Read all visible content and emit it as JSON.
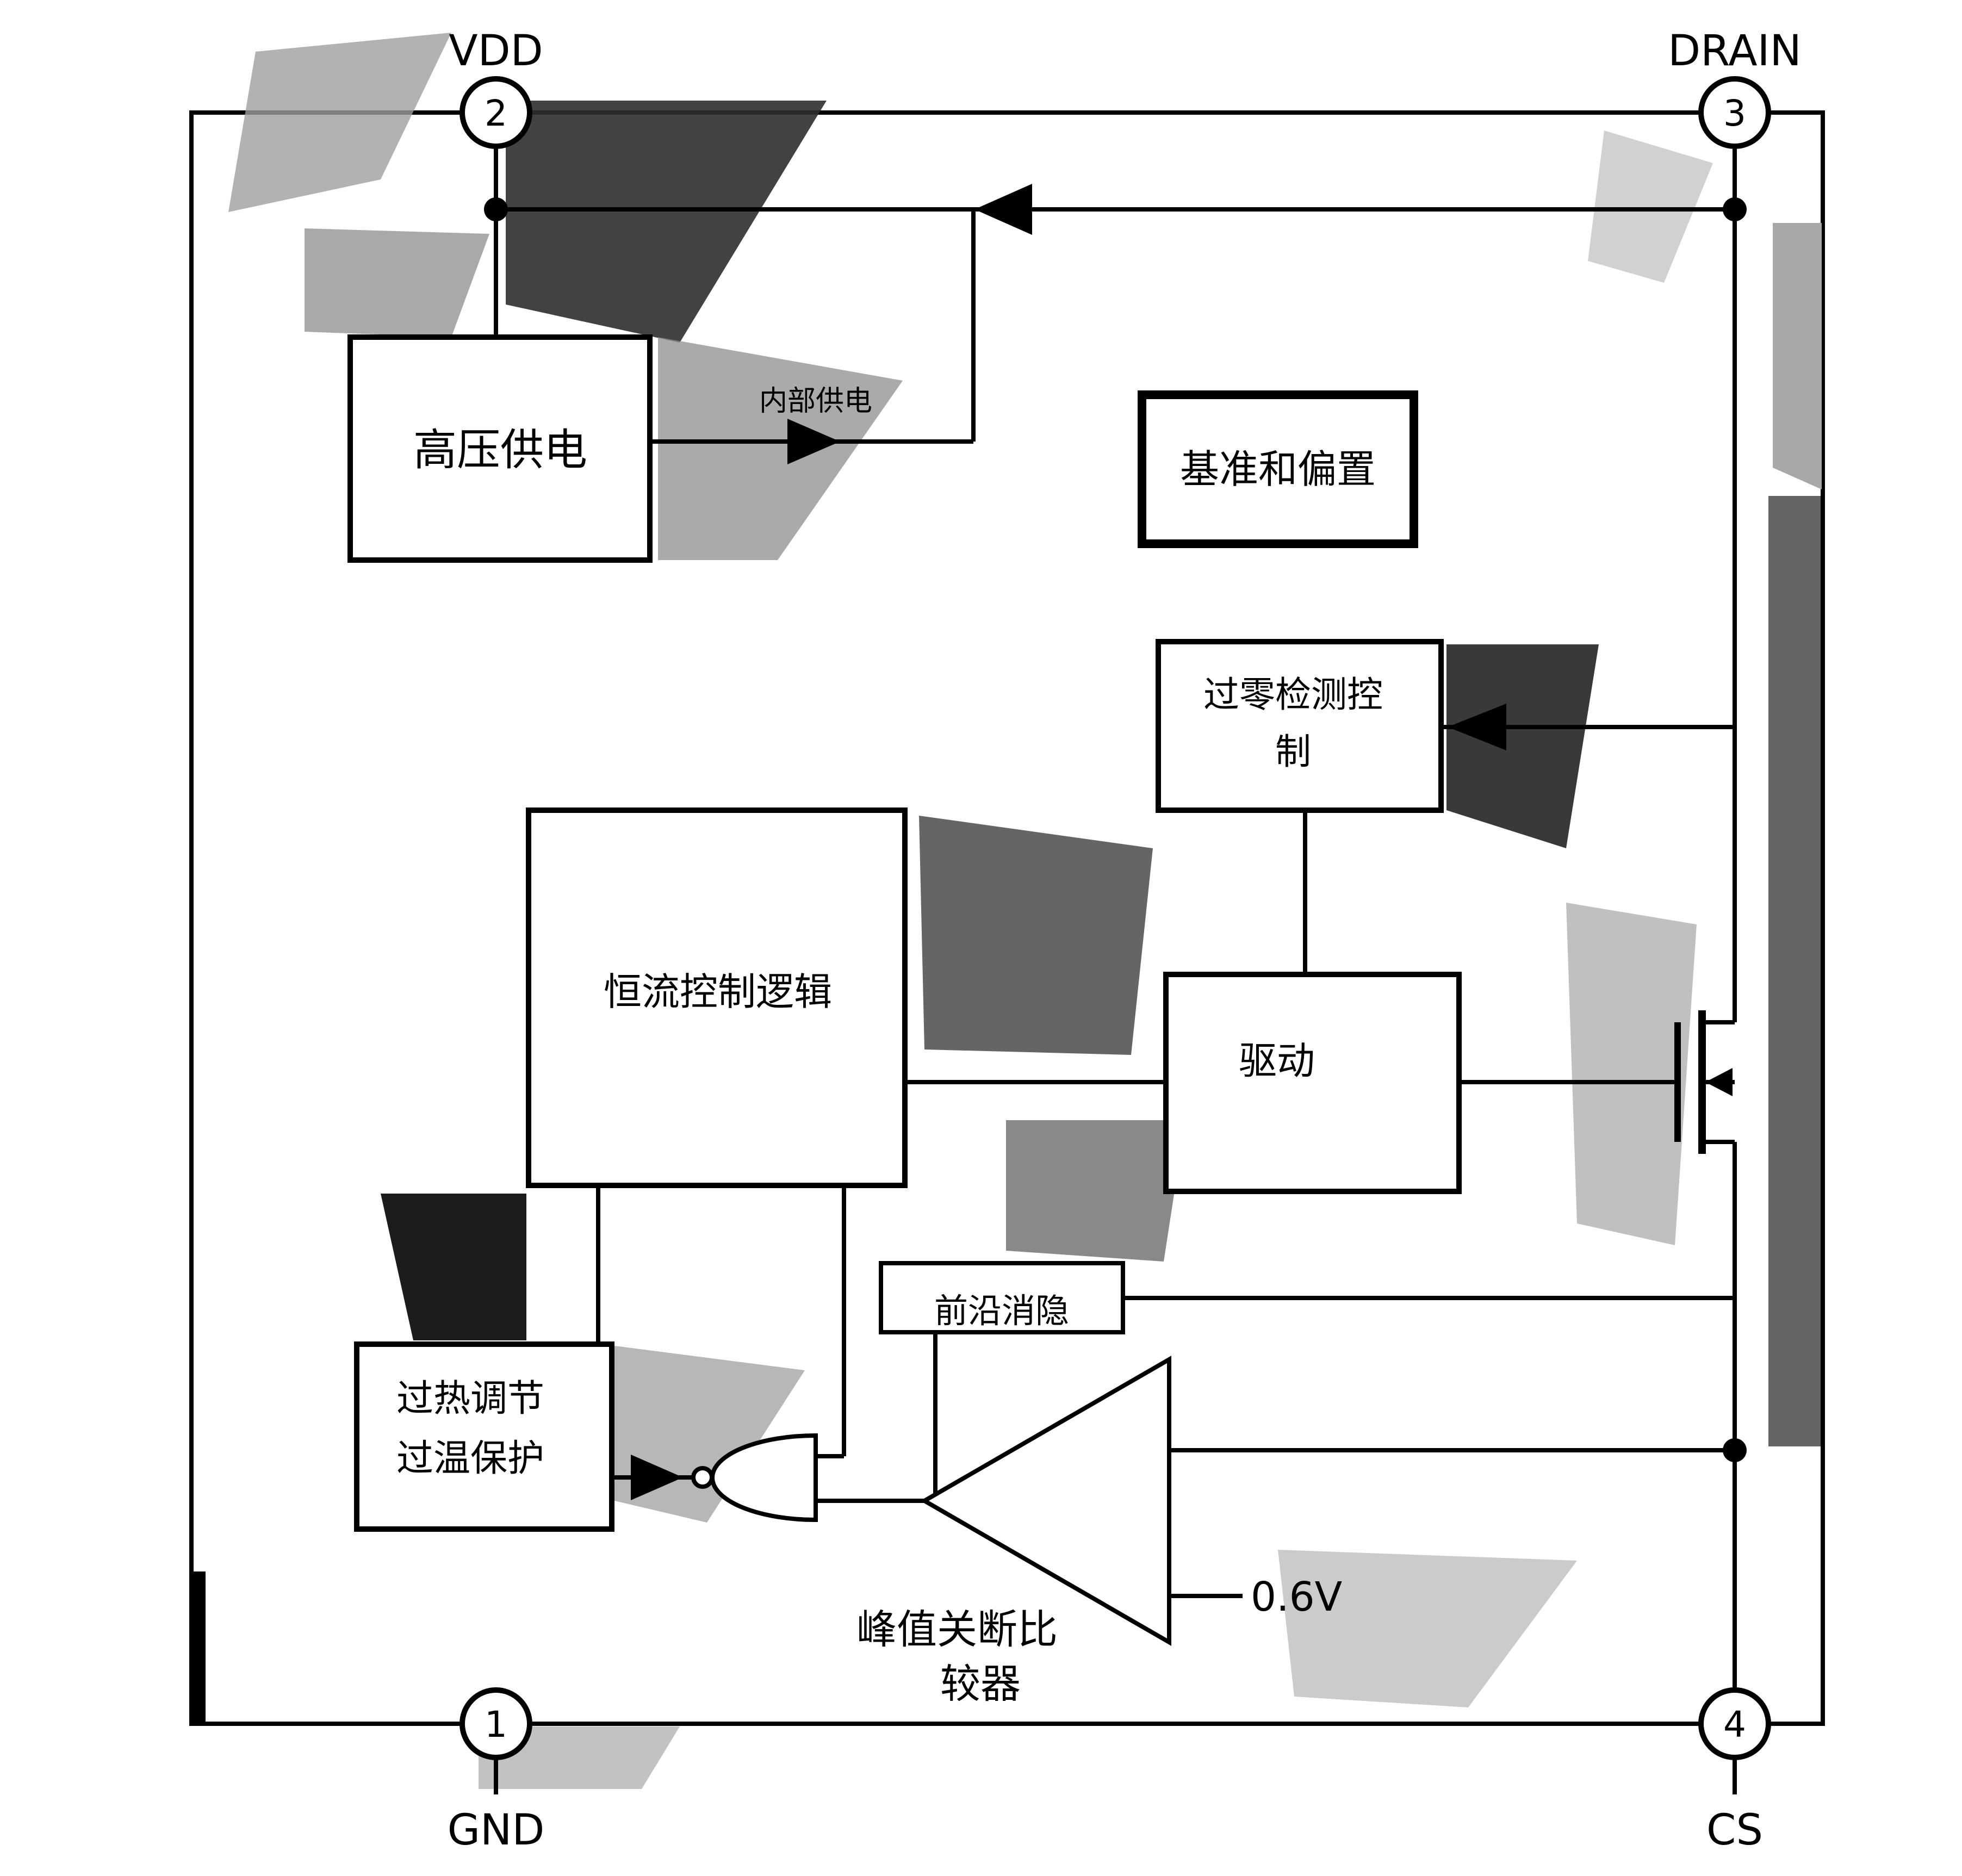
{
  "pins": {
    "vdd": {
      "label": "VDD",
      "number": "2"
    },
    "drain": {
      "label": "DRAIN",
      "number": "3"
    },
    "gnd": {
      "label": "GND",
      "number": "1"
    },
    "cs": {
      "label": "CS",
      "number": "4"
    }
  },
  "blocks": {
    "hv_supply": {
      "label": "高压供电"
    },
    "ref_bias": {
      "label": "基准和偏置"
    },
    "zcd": {
      "line1": "过零检测控",
      "line2": "制"
    },
    "cc_logic": {
      "label": "恒流控制逻辑"
    },
    "driver": {
      "label": "驱动"
    },
    "leb": {
      "label": "前沿消隐"
    },
    "thermal": {
      "line1": "过热调节",
      "line2": "过温保护"
    }
  },
  "labels": {
    "internal_supply": "内部供电",
    "vref": "0.6V",
    "peak_comparator_line1": "峰值关断比",
    "peak_comparator_line2": "较器"
  },
  "colors": {
    "line": "#000000",
    "block_fill": "#ffffff",
    "background": "#ffffff"
  }
}
